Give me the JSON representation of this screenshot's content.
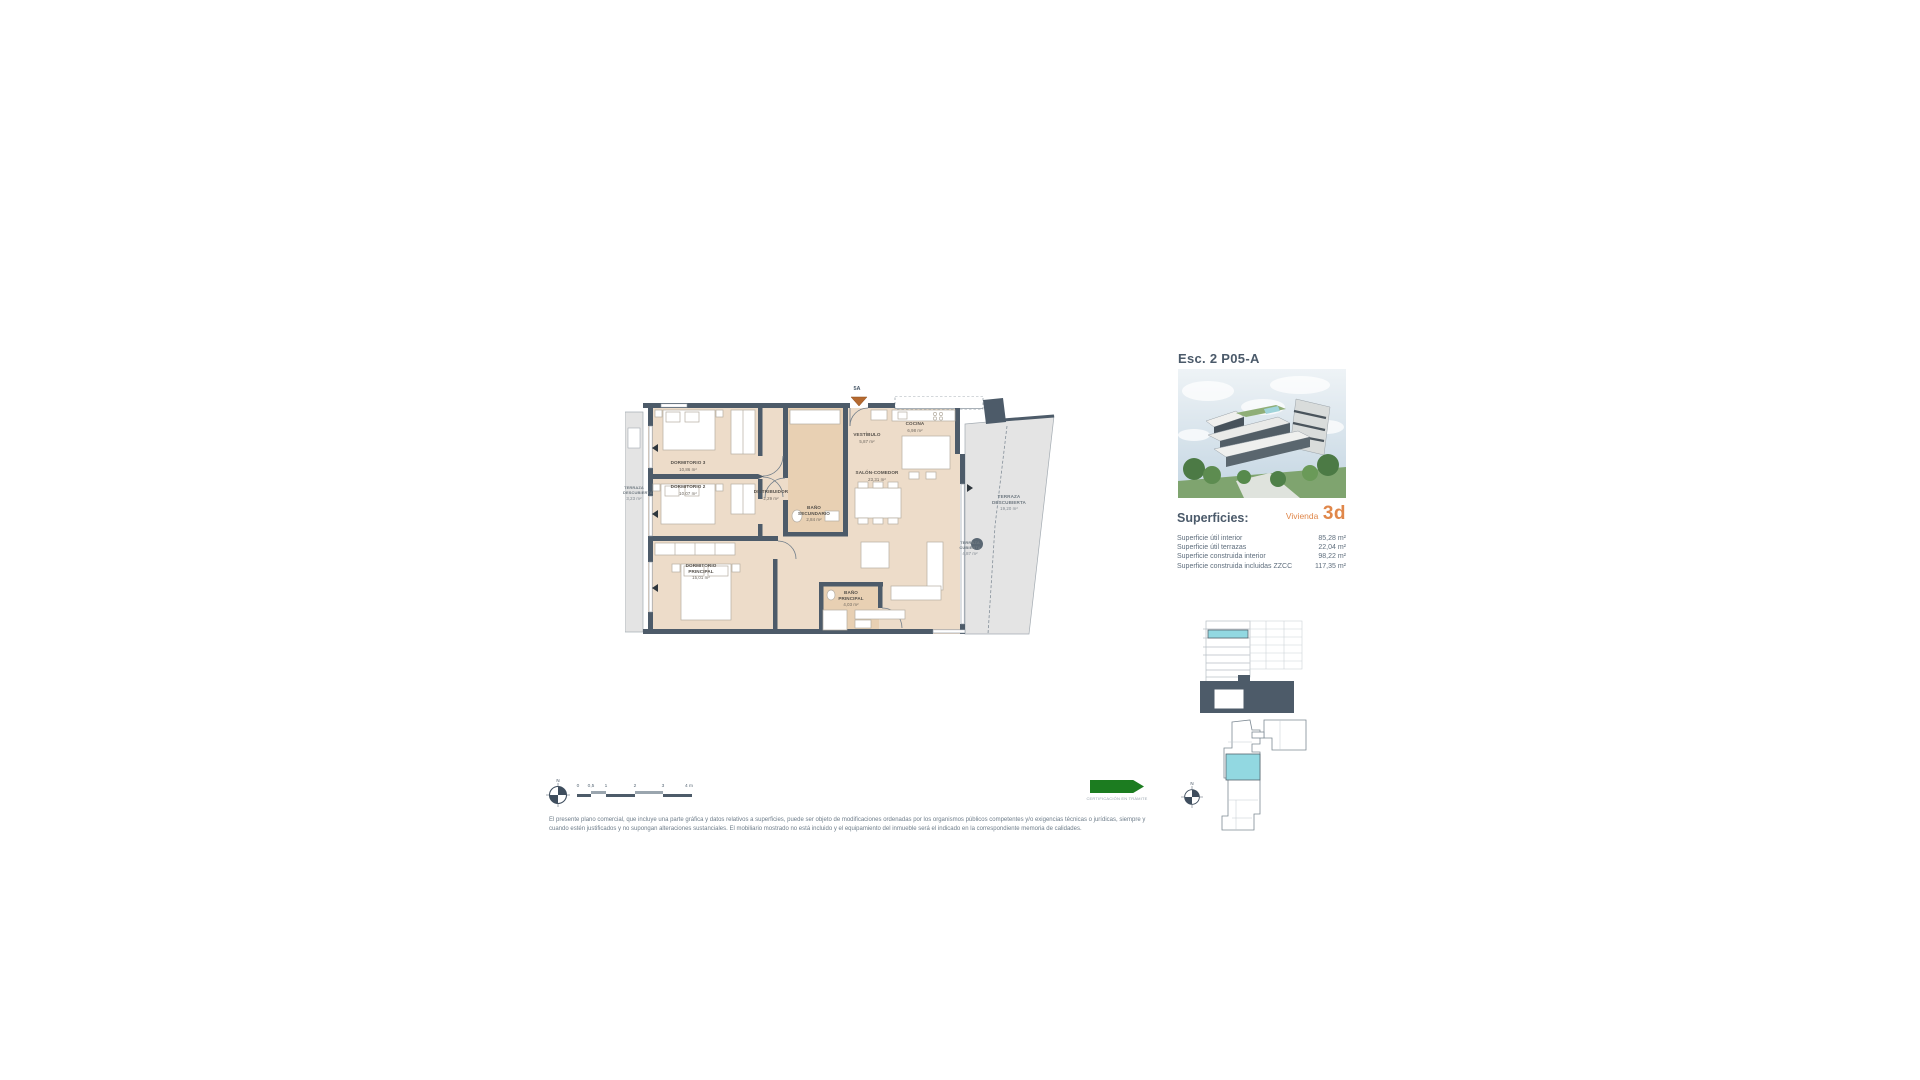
{
  "header": {
    "plan_ref": "Esc. 2 P05-A"
  },
  "superficies": {
    "title": "Superficies:",
    "vivienda_label": "Vivienda",
    "vivienda_value": "3d",
    "rows": [
      {
        "label": "Superficie útil interior",
        "value": "85,28 m²"
      },
      {
        "label": "Superficie útil terrazas",
        "value": "22,04 m²"
      },
      {
        "label": "Superficie construida interior",
        "value": "98,22 m²"
      },
      {
        "label": "Superficie construida incluidas ZZCC",
        "value": "117,35 m²"
      }
    ]
  },
  "floorplan": {
    "entrance_label": "5A",
    "rooms": [
      {
        "name": "DORMITORIO 3",
        "area": "10,86 m²"
      },
      {
        "name": "DORMITORIO 2",
        "area": "10,07 m²"
      },
      {
        "name": "DORMITORIO PRINCIPAL",
        "area": "15,01 m²"
      },
      {
        "name": "DISTRIBUIDOR",
        "area": "2,29 m²"
      },
      {
        "name": "BAÑO SECUNDARIO",
        "area": "2,84 m²"
      },
      {
        "name": "VESTÍBULO",
        "area": "5,87 m²"
      },
      {
        "name": "COCINA",
        "area": "6,98 m²"
      },
      {
        "name": "SALÓN-COMEDOR",
        "area": "23,31 m²"
      },
      {
        "name": "BAÑO PRINCIPAL",
        "area": "4,03 m²"
      },
      {
        "name": "TERRAZA DESCUBIERTA",
        "area": "3,23 m²"
      },
      {
        "name": "TERRAZA CUBIERTA",
        "area": "4,87 m²"
      },
      {
        "name": "TERRAZA DESCUBIERTA",
        "area": "19,20 m²"
      }
    ]
  },
  "scalebar": {
    "north": "N",
    "ticks": [
      "0",
      "0,5",
      "1",
      "2",
      "3",
      "4 m"
    ]
  },
  "keyplan": {
    "north": "N"
  },
  "certification": {
    "label": "CERTIFICACIÓN EN TRÁMITE"
  },
  "disclaimer": {
    "line1": "El presente plano comercial, que incluye una parte gráfica y datos relativos a superficies, puede ser objeto de modificaciones ordenadas por los organismos públicos competentes y/o exigencias técnicas o jurídicas, siempre y",
    "line2": "cuando estén justificados y no supongan alteraciones sustanciales. El mobiliario mostrado no está incluido y el equipamiento del inmueble será el indicado en la correspondiente memoria de calidades."
  },
  "colors": {
    "accent_orange": "#e0874a",
    "wall_slate": "#4d5b69",
    "highlight_cyan": "#92d8e1",
    "cert_green": "#1c7c20"
  }
}
